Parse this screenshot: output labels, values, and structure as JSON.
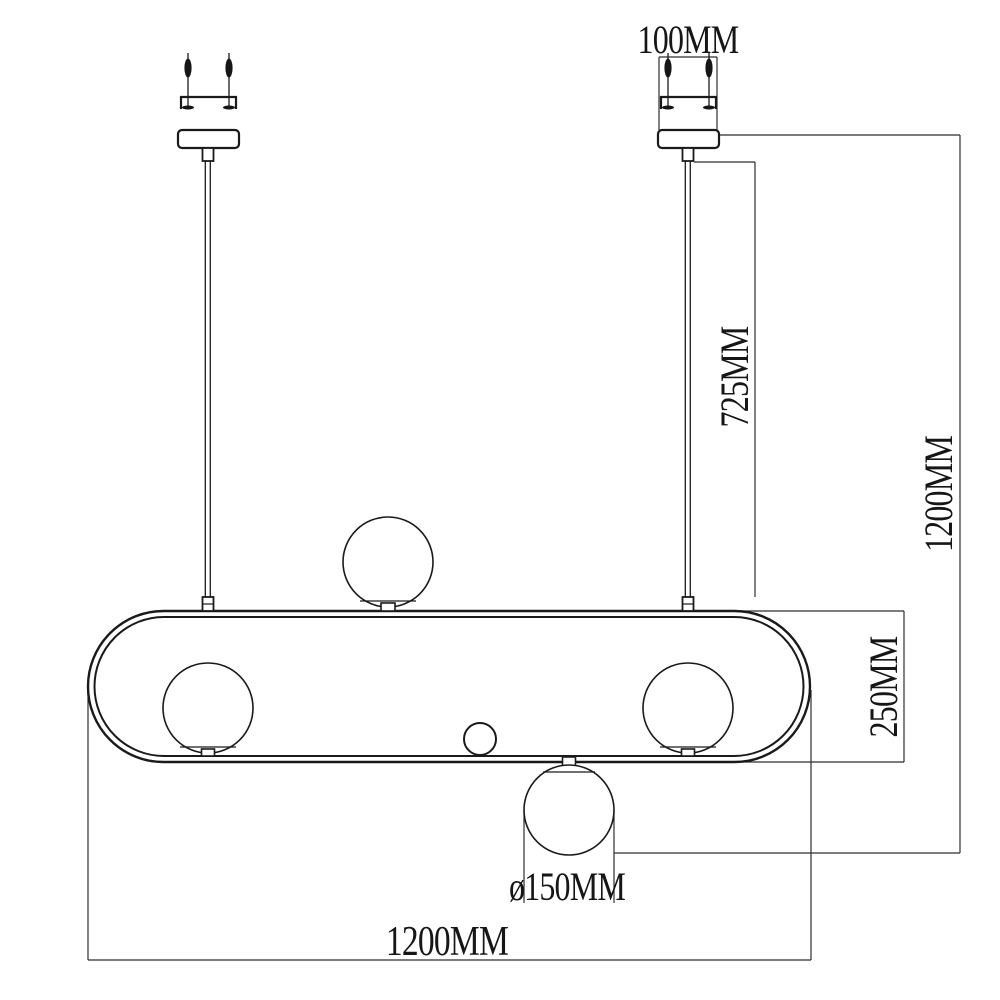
{
  "drawing": {
    "colors": {
      "background": "#ffffff",
      "object_line": "#1a1a1a",
      "dimension_line": "#2e2e2e"
    },
    "dimensions": {
      "mount_plate_width": "100MM",
      "suspension_rod_drop": "725MM",
      "overall_drop_height": "1200MM",
      "frame_height": "250MM",
      "globe_diameter": "ø150MM",
      "overall_width": "1200MM"
    }
  }
}
